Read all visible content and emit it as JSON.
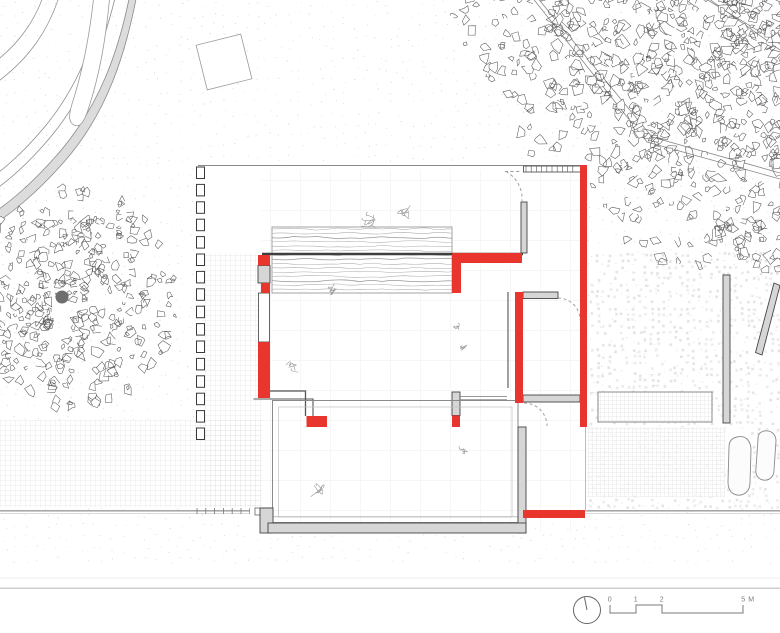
{
  "colors": {
    "background": "#ffffff",
    "red_accent": "#e8352e",
    "wall_fill": "#d6d6d6",
    "wall_line": "#454545",
    "line_dark": "#3f3f3f",
    "line_mid": "#8c8c8c",
    "line_light": "#c6c6c6",
    "grid_paving": "#d8d8d8",
    "grid_faint": "#ededed",
    "water_line": "#aeaeae",
    "leaf_stroke": "#585858",
    "stipple": "#c8c8c8",
    "plant_stroke": "#9c9c9c",
    "scalebar_ink": "#787878"
  },
  "scalebar": {
    "labels": [
      "0",
      "1",
      "2",
      "5 M"
    ]
  },
  "icons": {
    "north_indicator": "compass-circle-with-needle"
  }
}
